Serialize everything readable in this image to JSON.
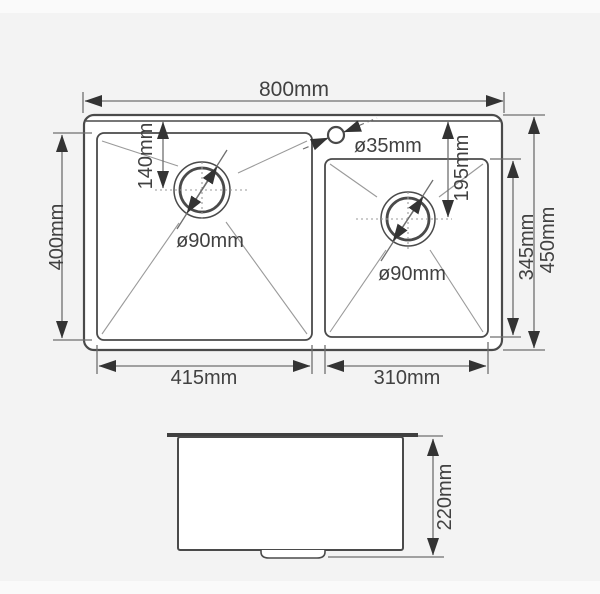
{
  "drawing": {
    "type": "sink-technical-drawing",
    "views": [
      "top-view",
      "side-view"
    ]
  },
  "colors": {
    "background": "#f3f3f3",
    "paper_band": "#fafafa",
    "outline": "#4a4a4a",
    "dimension_line": "#6f6f6f",
    "arrow": "#333333",
    "text": "#414141",
    "surface_fill": "#ffffff"
  },
  "top_view": {
    "overall_width": "800mm",
    "overall_depth": "450mm",
    "left_bowl_depth": "400mm",
    "left_bowl_width": "415mm",
    "right_bowl_width": "310mm",
    "right_bowl_depth": "345mm",
    "left_drain_offset": "140mm",
    "right_drain_offset": "195mm",
    "left_drain_diameter": "ø90mm",
    "right_drain_diameter": "ø90mm",
    "faucet_hole_diameter": "ø35mm"
  },
  "side_view": {
    "bowl_height": "220mm"
  }
}
